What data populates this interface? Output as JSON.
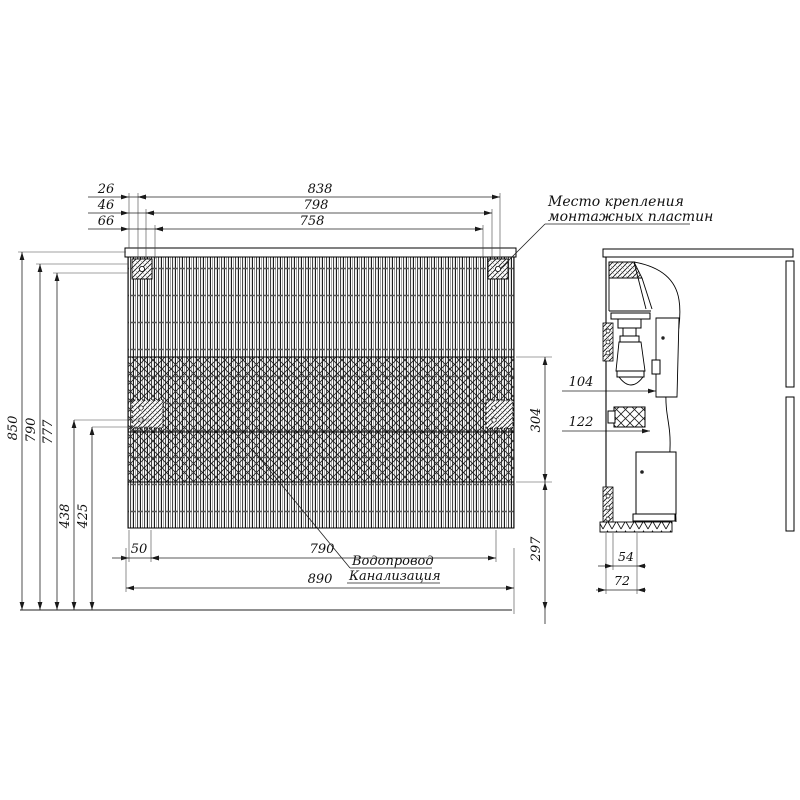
{
  "notes": {
    "mounting": {
      "line1": "Место крепления",
      "line2": "монтажных пластин"
    },
    "utilities": {
      "line1": "Водопровод",
      "line2": "Канализация"
    }
  },
  "dimensions": {
    "top": {
      "offset1": "26",
      "offset2": "46",
      "offset3": "66",
      "width1": "838",
      "width2": "798",
      "width3": "758"
    },
    "left": {
      "height_total": "850",
      "height_body": "790",
      "height_apron": "777",
      "plate_upper": "438",
      "plate_lower": "425"
    },
    "bottom": {
      "edge_offset": "50",
      "span": "790",
      "overall_width": "890"
    },
    "right": {
      "zone_height": "304",
      "zone_bottom": "297",
      "depth_trap": "104",
      "depth_plate": "122"
    },
    "side": {
      "rail_depth": "54",
      "depth_total": "72"
    }
  }
}
